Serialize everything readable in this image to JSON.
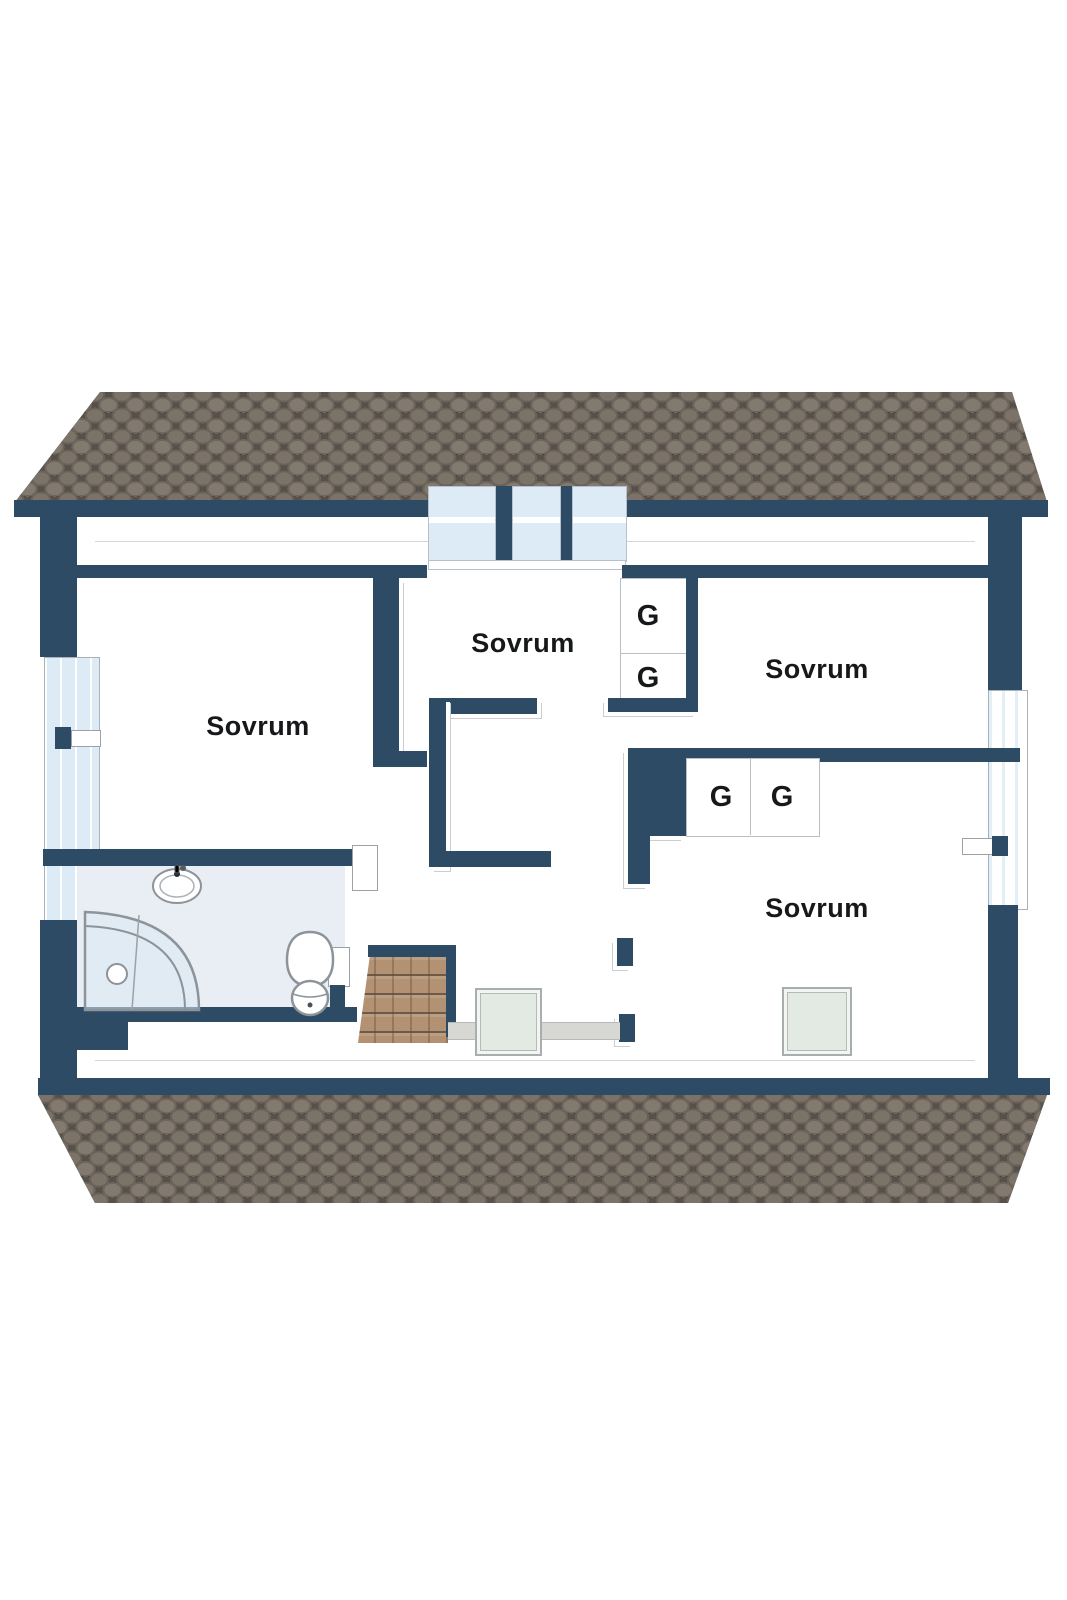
{
  "plan": {
    "type": "floor-plan-3d-cutaway",
    "language": "Swedish",
    "rooms": [
      {
        "id": "bedroom-top-left",
        "label": "Sovrum"
      },
      {
        "id": "bedroom-middle",
        "label": "Sovrum"
      },
      {
        "id": "bedroom-top-right",
        "label": "Sovrum"
      },
      {
        "id": "bedroom-bottom-right",
        "label": "Sovrum"
      }
    ],
    "closets": [
      {
        "id": "closet-stack-top",
        "label": "G"
      },
      {
        "id": "closet-stack-bottom",
        "label": "G"
      },
      {
        "id": "closet-pair-left",
        "label": "G"
      },
      {
        "id": "closet-pair-right",
        "label": "G"
      }
    ],
    "fixtures": [
      "sink",
      "corner-shower",
      "toilet",
      "winder-stairs",
      "skylight",
      "skylight"
    ],
    "colors": {
      "wall": "#2e4b66",
      "roof_base": "#56504a",
      "roof_shingle": "#7b7268",
      "window_glass": "#dcebf5",
      "stair_wood": "#b29272",
      "skylight_glass": "#e3eae4",
      "bathroom_floor": "#e9eef4"
    }
  }
}
